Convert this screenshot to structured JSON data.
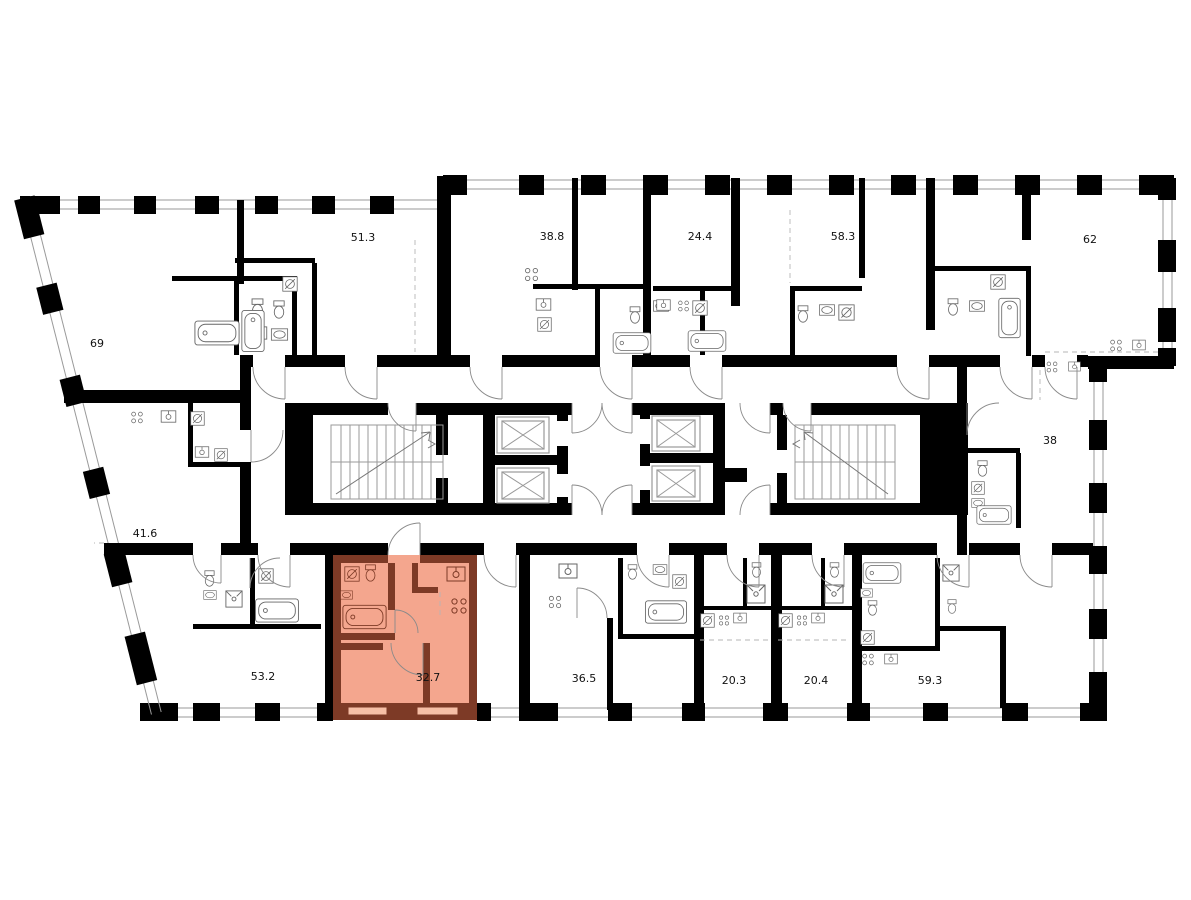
{
  "plan": {
    "type": "residential-floor-plan",
    "selected_unit": {
      "area": "32.7"
    },
    "counts": {
      "stair_cores": 2,
      "elevators": 4,
      "units_labeled": 14
    },
    "colors": {
      "background": "#ffffff",
      "wall": "#000000",
      "window_line": "#9a9a9a",
      "label_color": "#111111",
      "highlight_fill": "#f4a68e",
      "highlight_wall": "#7d3a26",
      "highlight_window": "#f6bfa6"
    },
    "units": [
      {
        "id": "unit-69",
        "area": "69",
        "x": 97,
        "y": 347,
        "highlighted": false
      },
      {
        "id": "unit-51-3",
        "area": "51.3",
        "x": 363,
        "y": 241,
        "highlighted": false
      },
      {
        "id": "unit-38-8",
        "area": "38.8",
        "x": 552,
        "y": 240,
        "highlighted": false
      },
      {
        "id": "unit-24-4",
        "area": "24.4",
        "x": 700,
        "y": 240,
        "highlighted": false
      },
      {
        "id": "unit-58-3",
        "area": "58.3",
        "x": 843,
        "y": 240,
        "highlighted": false
      },
      {
        "id": "unit-62",
        "area": "62",
        "x": 1090,
        "y": 243,
        "highlighted": false
      },
      {
        "id": "unit-38",
        "area": "38",
        "x": 1050,
        "y": 444,
        "highlighted": false
      },
      {
        "id": "unit-41-6",
        "area": "41.6",
        "x": 145,
        "y": 537,
        "highlighted": false
      },
      {
        "id": "unit-53-2",
        "area": "53.2",
        "x": 263,
        "y": 680,
        "highlighted": false
      },
      {
        "id": "unit-32-7",
        "area": "32.7",
        "x": 428,
        "y": 681,
        "highlighted": true
      },
      {
        "id": "unit-36-5",
        "area": "36.5",
        "x": 584,
        "y": 682,
        "highlighted": false
      },
      {
        "id": "unit-20-3",
        "area": "20.3",
        "x": 734,
        "y": 684,
        "highlighted": false
      },
      {
        "id": "unit-20-4",
        "area": "20.4",
        "x": 816,
        "y": 684,
        "highlighted": false
      },
      {
        "id": "unit-59-3",
        "area": "59.3",
        "x": 930,
        "y": 684,
        "highlighted": false
      }
    ]
  }
}
